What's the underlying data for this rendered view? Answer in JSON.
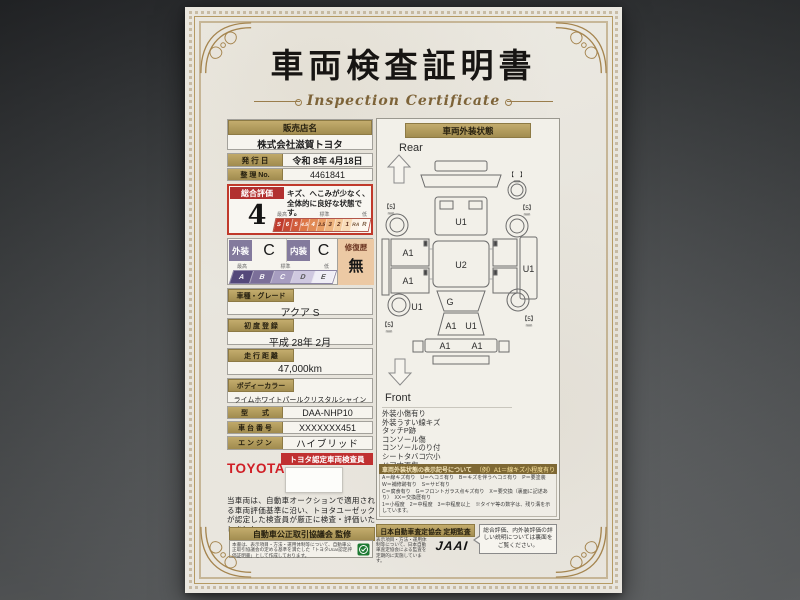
{
  "title": {
    "jp": "車両検査証明書",
    "en": "Inspection Certificate"
  },
  "dealer": {
    "label": "販売店名",
    "name": "株式会社滋賀トヨタ"
  },
  "issue_date": {
    "label": "発 行 日",
    "value": "令和 8年 4月18日"
  },
  "control_no": {
    "label": "整 理 No.",
    "value": "4461841"
  },
  "overall": {
    "label": "総合評価",
    "score": "4",
    "comment": "キズ、へこみが少なく、全体的に良好な状態です。",
    "scale": {
      "high": "最高",
      "mid": "標準",
      "low": "低",
      "grades": [
        "S",
        "6",
        "5",
        "4.5",
        "4",
        "3.5",
        "3",
        "2",
        "1",
        "RA",
        "R"
      ]
    }
  },
  "grades": {
    "exterior_label": "外装",
    "exterior": "C",
    "interior_label": "内装",
    "interior": "C",
    "repair_label": "修復歴",
    "repair": "無",
    "scale": {
      "high": "最高",
      "mid": "標準",
      "low": "低",
      "grades": [
        "A",
        "B",
        "C",
        "D",
        "E"
      ]
    }
  },
  "fields": {
    "model": {
      "label": "車種・グレード",
      "value": "アクア S"
    },
    "first_reg": {
      "label": "初 度 登 録",
      "value": "平成 28年 2月"
    },
    "mileage": {
      "label": "走 行 距 離",
      "value": "47,000km"
    },
    "body_color": {
      "label": "ボディーカラー",
      "value": "ライムホワイトパールクリスタルシャイン"
    },
    "model_code": {
      "label": "型　　式",
      "value": "DAA-NHP10"
    },
    "chassis_no": {
      "label": "車 台 番 号",
      "value": "XXXXXXX451"
    },
    "engine": {
      "label": "エ ン ジ ン",
      "value": "ハイブリッド"
    }
  },
  "inspector": {
    "brand": "TOYOTA",
    "badge": "トヨタ認定車両検査員"
  },
  "disclaimer": "当車両は、自動車オークションで適用される車両評価基準に沿い、トヨタユーゼックが認定した検査員が厳正に検査・評価いたしました。",
  "exterior": {
    "header": "車両外装状態",
    "rear": "Rear",
    "front": "Front",
    "marks": {
      "hatch": "U1",
      "roof": "U2",
      "windshield": "G",
      "hood_a": "A1",
      "hood_b": "U1",
      "bumper_l": "A1",
      "bumper_r": "A1",
      "door_rear": "A1",
      "door_front": "A1",
      "side_front": "U1",
      "side_sill": "U1"
    },
    "tires": {
      "unit": "mm",
      "rear_l": "【5】",
      "rear_r": "【5】",
      "front_l": "【5】",
      "front_r": "【5】",
      "spare": "【　】"
    },
    "notes": [
      "外装小傷有り",
      "外装うすい線キズ",
      "タッチP跡",
      "コンソール傷",
      "コンソールのり付",
      "シートタバコ穴小",
      "ドア内張傷",
      "荷室内張傷",
      "ハンドル傷"
    ],
    "legend": {
      "header": "車両外装状態の表示記号について",
      "example": "（例）A1＝線キズ小程度有り",
      "lines": [
        "A＝線キズ有り　U＝ヘコミ有り　B＝キズを伴うヘコミ有り　P＝要塗装　W＝補修跡有り　S＝サビ有り",
        "C＝腐食有り　G＝フロントガラス点キズ有り　X＝要交換（裏面に記述あり）　XX＝交換歴有り",
        "1＝小程度　2＝中程度　3＝中程度以上　※タイヤ等の数字は、残り溝を示しています。"
      ]
    }
  },
  "footer": {
    "fair_trade": {
      "header": "自動車公正取引協議会 監修",
      "text": "本書は、表示項目・方法・運用体制等について、自動車公正取引協議会の定める基準を満たした「トヨタUcar認定評価証明書」として作成しております。"
    },
    "jaai": {
      "header": "日本自動車査定協会 定期監査",
      "text": "表示項目・方法・運用体制等について、日本自動車査定協会による監査を定期的に実施しています。",
      "logo": "JAAI"
    },
    "backside_note": "総合評価、内外装評価の詳しい説明については裏面をご覧ください。"
  }
}
